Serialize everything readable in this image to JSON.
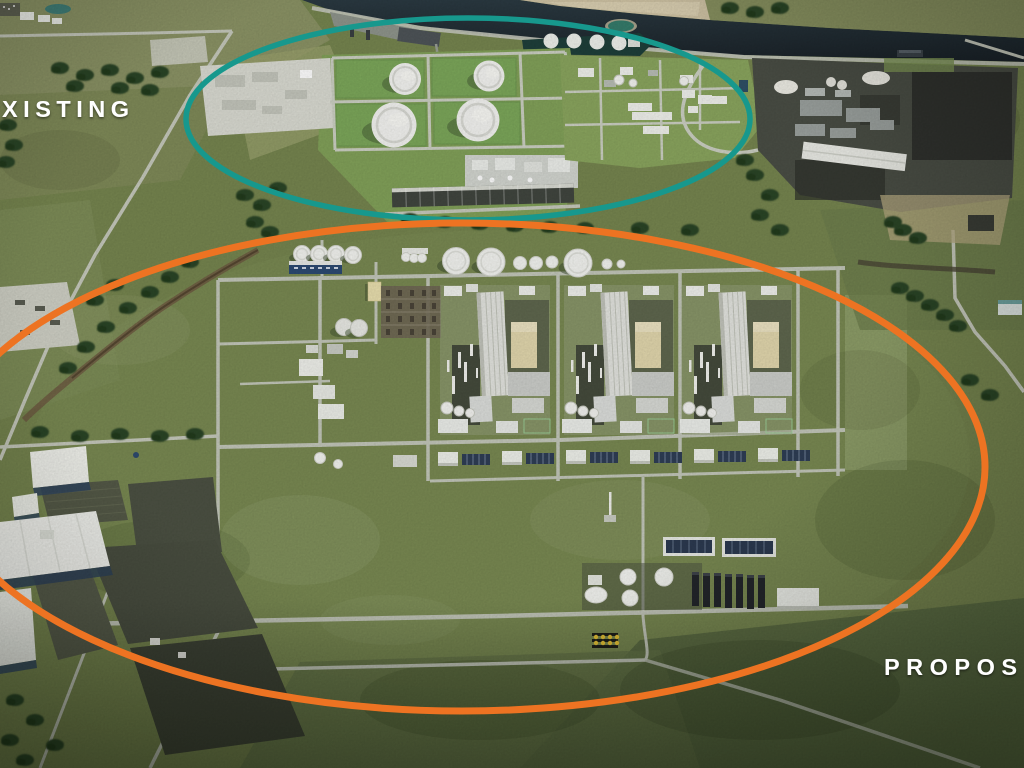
{
  "annotations": {
    "existing": {
      "label": "XISTING",
      "ellipse_color": "#17988d"
    },
    "proposed": {
      "label": "PROPOS",
      "ellipse_color": "#ed7322"
    },
    "label_color": "#ffffff"
  },
  "scene": {
    "palette": {
      "water": "#242d34",
      "grass": "#76854f",
      "road": "#c3c7ba",
      "tank_white": "#f3f4f0",
      "industrial_dark": "#4a4e45"
    }
  }
}
